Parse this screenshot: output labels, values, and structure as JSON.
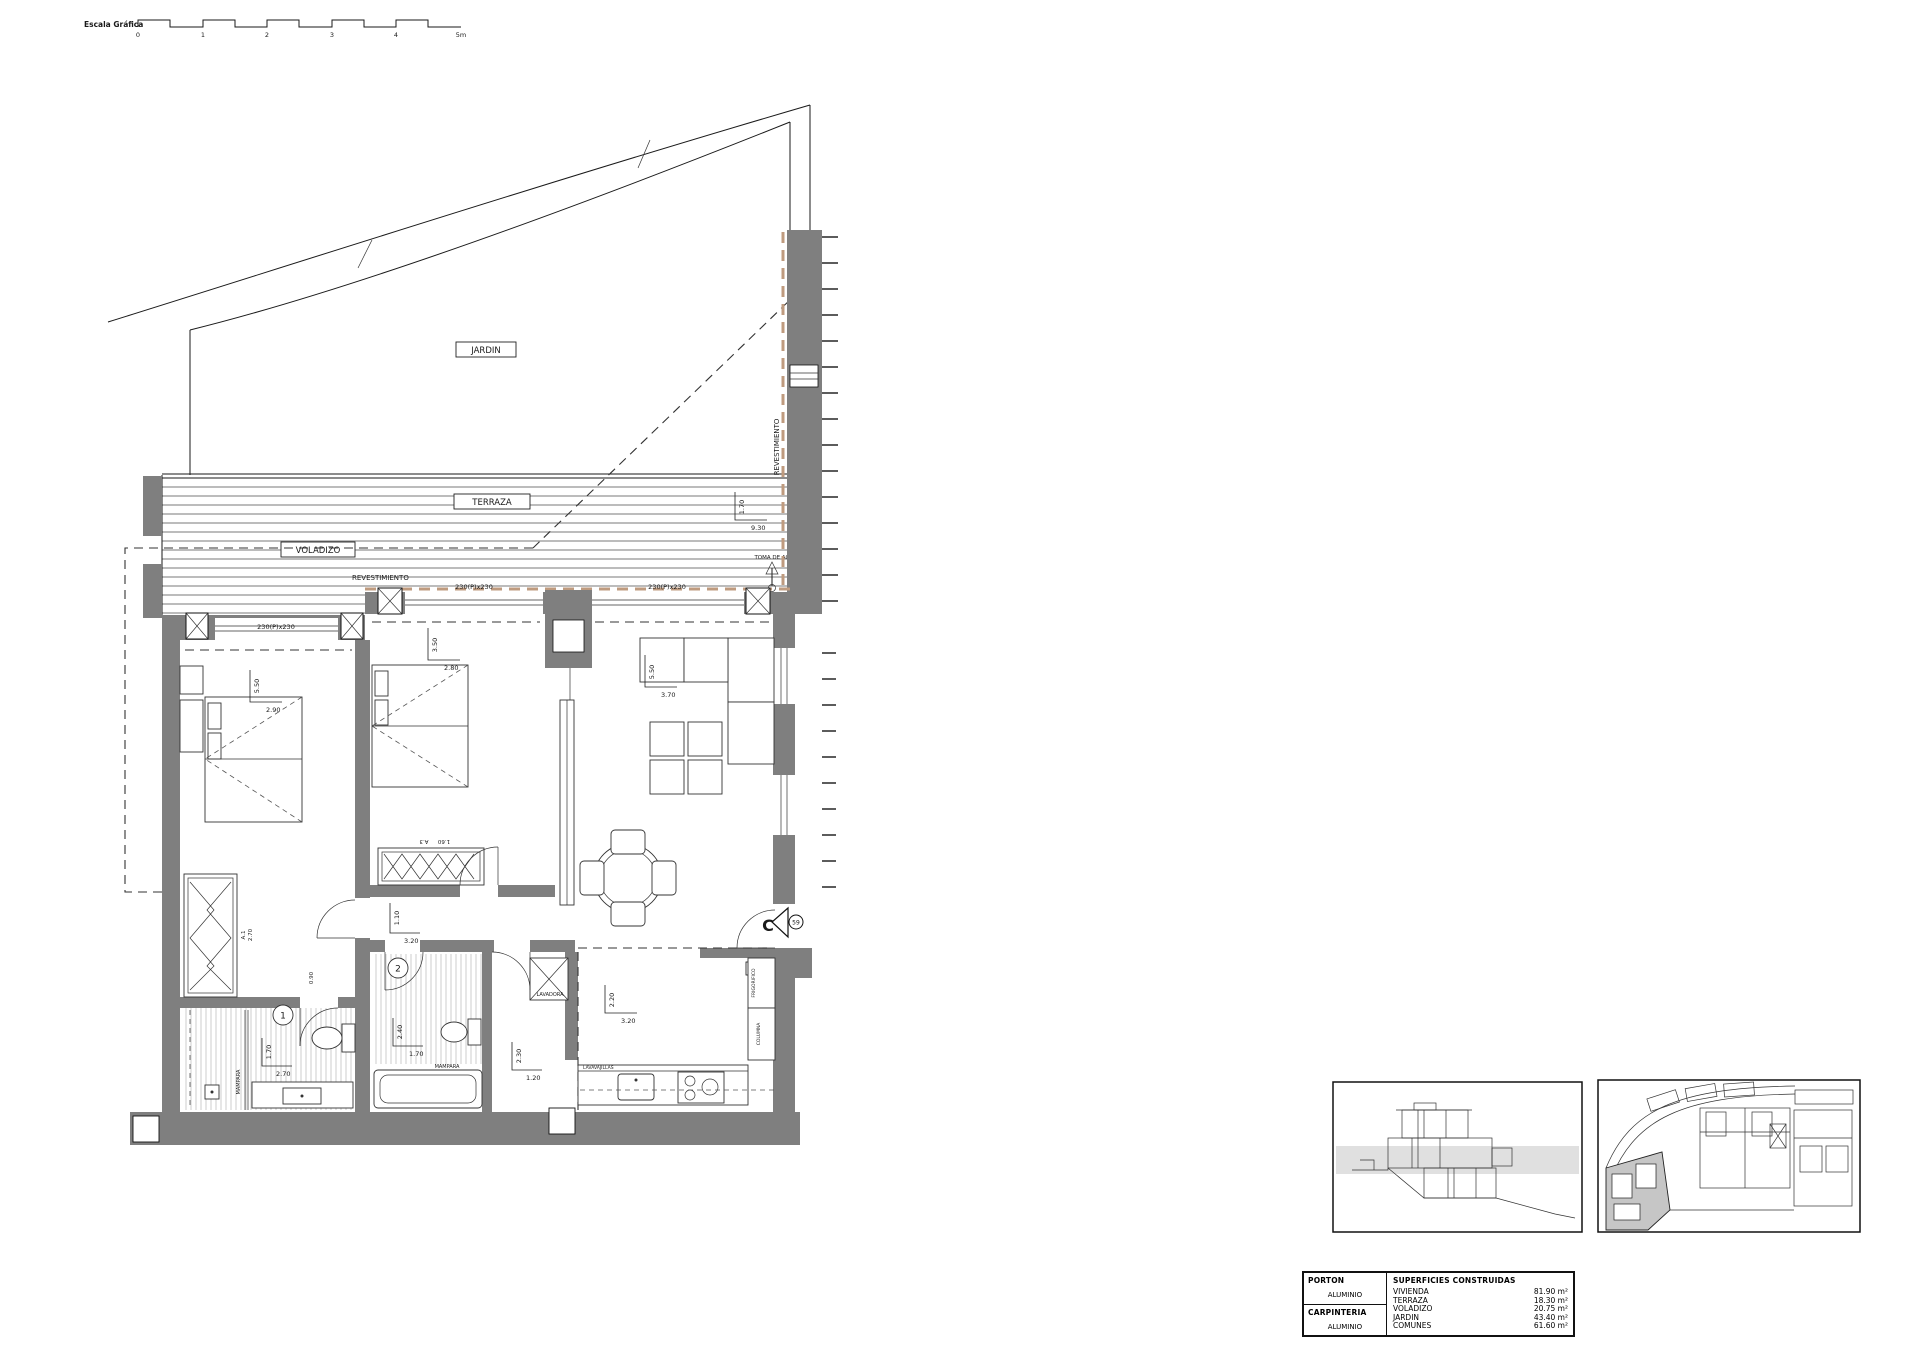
{
  "scale_bar": {
    "label": "Escala Gráfica",
    "ticks": [
      "0",
      "1",
      "2",
      "3",
      "4",
      "5m"
    ]
  },
  "labels": {
    "jardin": "JARDIN",
    "terraza": "TERRAZA",
    "voladizo": "VOLADIZO",
    "revestimiento_top": "REVESTIMIENTO",
    "revestimiento_right": "REVESTIMIENTO",
    "toma_de_agua": "TOMA DE AGUA",
    "window_1": "230(P)x230",
    "window_2": "230(P)x230",
    "window_3": "230(P)x230",
    "mampara_1": "MAMPARA",
    "mampara_2": "MAMPARA",
    "lavadora": "LAVADORA",
    "lavavajillas": "LAVAVAJILLAS",
    "columna": "COLUMNA",
    "frigorifico": "FRIGORIFICO",
    "wardrobe_a1": "A.1",
    "wardrobe_a1_width": "2.70",
    "wardrobe_a3": "A.3",
    "wardrobe_a3_width": "1.60",
    "bath1_number": "1",
    "bath2_number": "2",
    "section_letter": "C",
    "section_number": "59"
  },
  "dims": {
    "terrace_depth": "1.70",
    "terrace_width": "9.30",
    "bedroom1_depth": "5.50",
    "bedroom1_width": "2.90",
    "bedroom2_depth": "3.50",
    "bedroom2_width": "2.80",
    "living_depth": "5.50",
    "living_width": "3.70",
    "hall_depth": "1.10",
    "hall_width": "3.20",
    "bath1_depth": "1.70",
    "bath1_width": "2.70",
    "bath2_depth": "2.40",
    "bath2_width": "1.70",
    "laundry_depth": "2.30",
    "laundry_width": "1.20",
    "kitchen_depth": "2.20",
    "kitchen_width": "3.20",
    "door_width": "0.90"
  },
  "summary_table": {
    "materials": [
      {
        "title": "PORTON",
        "material": "ALUMINIO"
      },
      {
        "title": "CARPINTERIA",
        "material": "ALUMINIO"
      }
    ],
    "surfaces": {
      "header": "SUPERFICIES CONSTRUIDAS",
      "rows": [
        {
          "label": "VIVIENDA",
          "value": "81.90 m²"
        },
        {
          "label": "TERRAZA",
          "value": "18.30 m²"
        },
        {
          "label": "VOLADIZO",
          "value": "20.75 m²"
        },
        {
          "label": "JARDIN",
          "value": "43.40 m²"
        },
        {
          "label": "COMUNES",
          "value": "61.60 m²"
        }
      ]
    }
  },
  "colors": {
    "wall_gray": "#7f7f7f",
    "revestimiento_tan": "#bf9b7f",
    "highlight_gray": "#c6c6c6"
  }
}
